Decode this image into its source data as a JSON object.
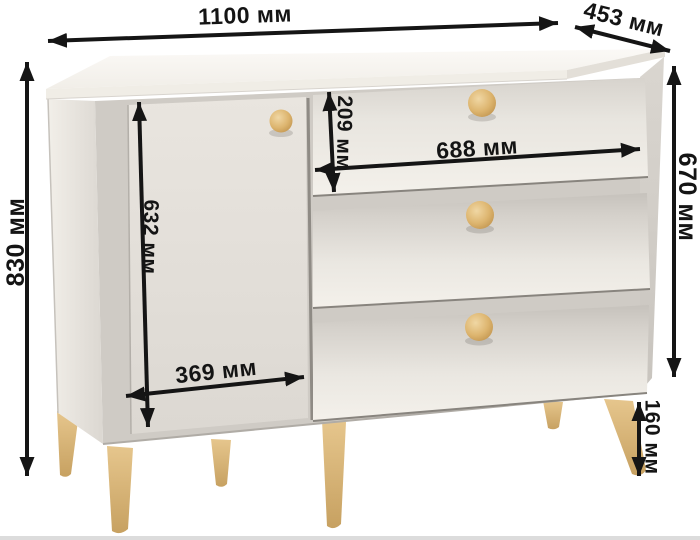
{
  "diagram": {
    "type": "furniture-dimension-diagram",
    "subject": "commode-with-door-and-3-drawers",
    "unit": "мм",
    "labels": {
      "total_width": "1100 мм",
      "depth": "453 мм",
      "total_height": "830 мм",
      "body_height": "670 мм",
      "top_drawer_height": "209 мм",
      "drawer_width": "688 мм",
      "door_height": "632 мм",
      "door_width": "369 мм",
      "leg_height": "160 мм"
    },
    "colors": {
      "background": "#ffffff",
      "body_light": "#f4f1eb",
      "body_mid": "#e2ded8",
      "drawer_shade": "#c8c4be",
      "wood_knob_leg": "#d9b87c",
      "dimension_lines": "#151515"
    }
  }
}
